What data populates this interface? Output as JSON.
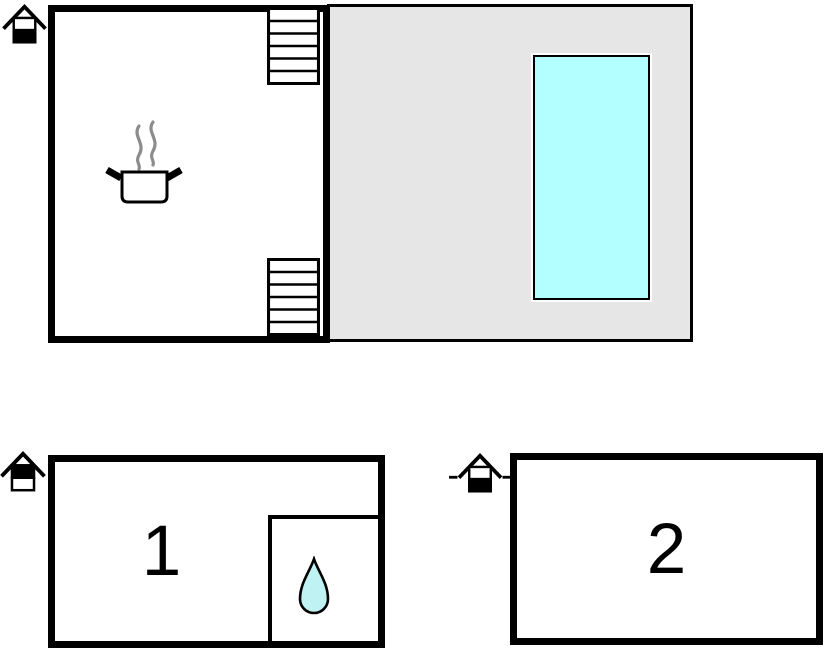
{
  "title": "Holiday home floor plan",
  "colors": {
    "wall": "#000000",
    "terrace_fill": "#e6e6e6",
    "pool_fill": "#b3ffff",
    "water_drop_fill": "#bff2f2",
    "steam_gray": "#8c8c8c"
  },
  "upper_floor": {
    "main_room": {
      "icons": [
        "stairs-upper",
        "stairs-lower",
        "cooking-pot"
      ]
    },
    "terrace": {
      "icons": [
        "swimming-pool"
      ]
    }
  },
  "ground_floor": {
    "rooms": [
      {
        "label": "1",
        "icons": [
          "water-drop"
        ]
      },
      {
        "label": "2",
        "icons": []
      }
    ]
  },
  "entrances": [
    {
      "icon": "entrance-house",
      "position": "top-left"
    },
    {
      "icon": "entrance-house",
      "position": "left-of-room-1"
    },
    {
      "icon": "entrance-house-with-dashes",
      "position": "left-of-room-2"
    }
  ]
}
